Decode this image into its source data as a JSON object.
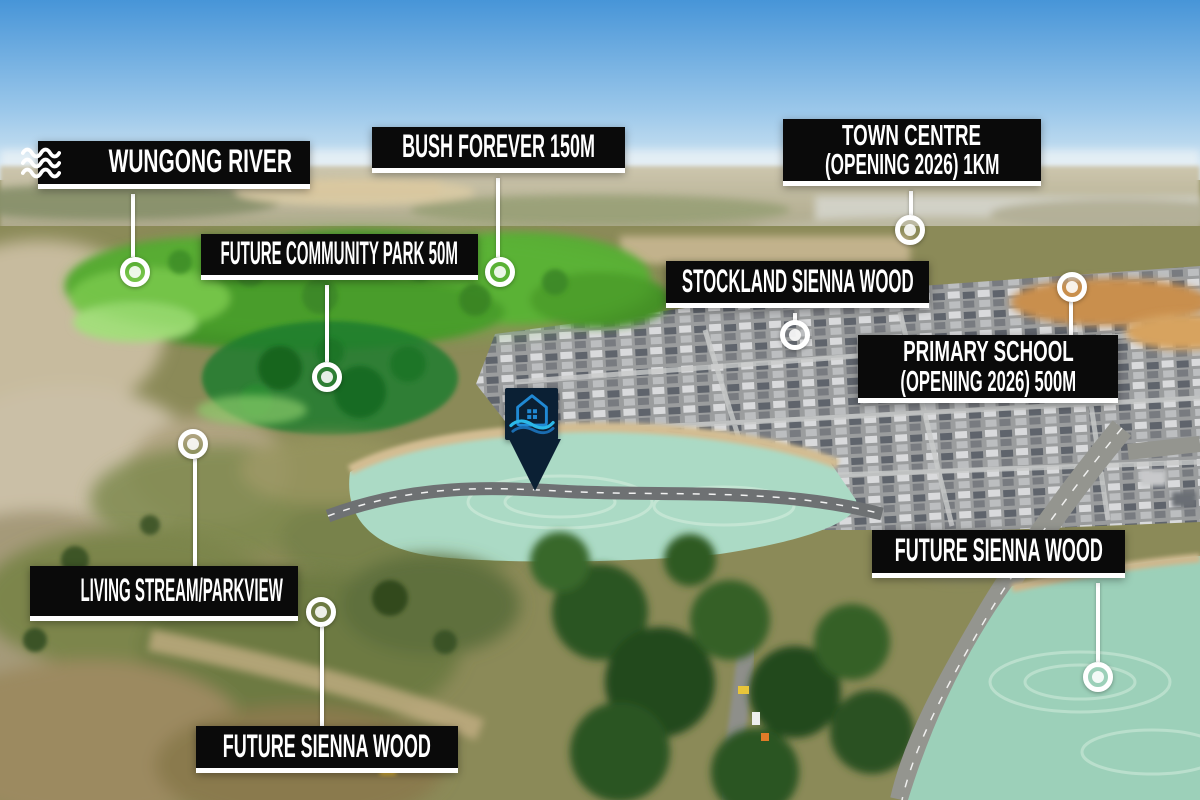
{
  "scene": {
    "description": "Aerial marketing photo of a land estate with black location callouts",
    "sky_color": "#4795d8",
    "bushland_highlight_color": "#53a832",
    "park_highlight_color": "#1b7c2d",
    "hydromulch_color": "#a9d9c4"
  },
  "style": {
    "label_bg": "#0a0a0a",
    "label_text_color": "#ffffff",
    "leader_color": "#ffffff",
    "logo_bg": "#0b2034",
    "logo_house_color": "#2089d4",
    "logo_wave_color_1": "#2cb9e8",
    "logo_wave_color_2": "#1a6cb0"
  },
  "callouts": {
    "wungong_river": {
      "text": "WUNGONG RIVER",
      "icon": "waves-icon"
    },
    "bush_forever": {
      "text": "BUSH FOREVER 150M"
    },
    "town_centre": {
      "line1": "TOWN CENTRE",
      "line2": "(OPENING 2026) 1KM"
    },
    "future_community_park": {
      "text": "FUTURE COMMUNITY PARK 50M"
    },
    "stockland_sienna_wood": {
      "text": "STOCKLAND SIENNA WOOD"
    },
    "primary_school": {
      "line1": "PRIMARY SCHOOL",
      "line2": "(OPENING 2026) 500M"
    },
    "living_stream_parkview": {
      "text": "LIVING STREAM/PARKVIEW",
      "icon": "droplet-icon"
    },
    "future_sienna_wood_right": {
      "text": "FUTURE SIENNA WOOD"
    },
    "future_sienna_wood_bottom": {
      "text": "FUTURE SIENNA WOOD"
    }
  }
}
